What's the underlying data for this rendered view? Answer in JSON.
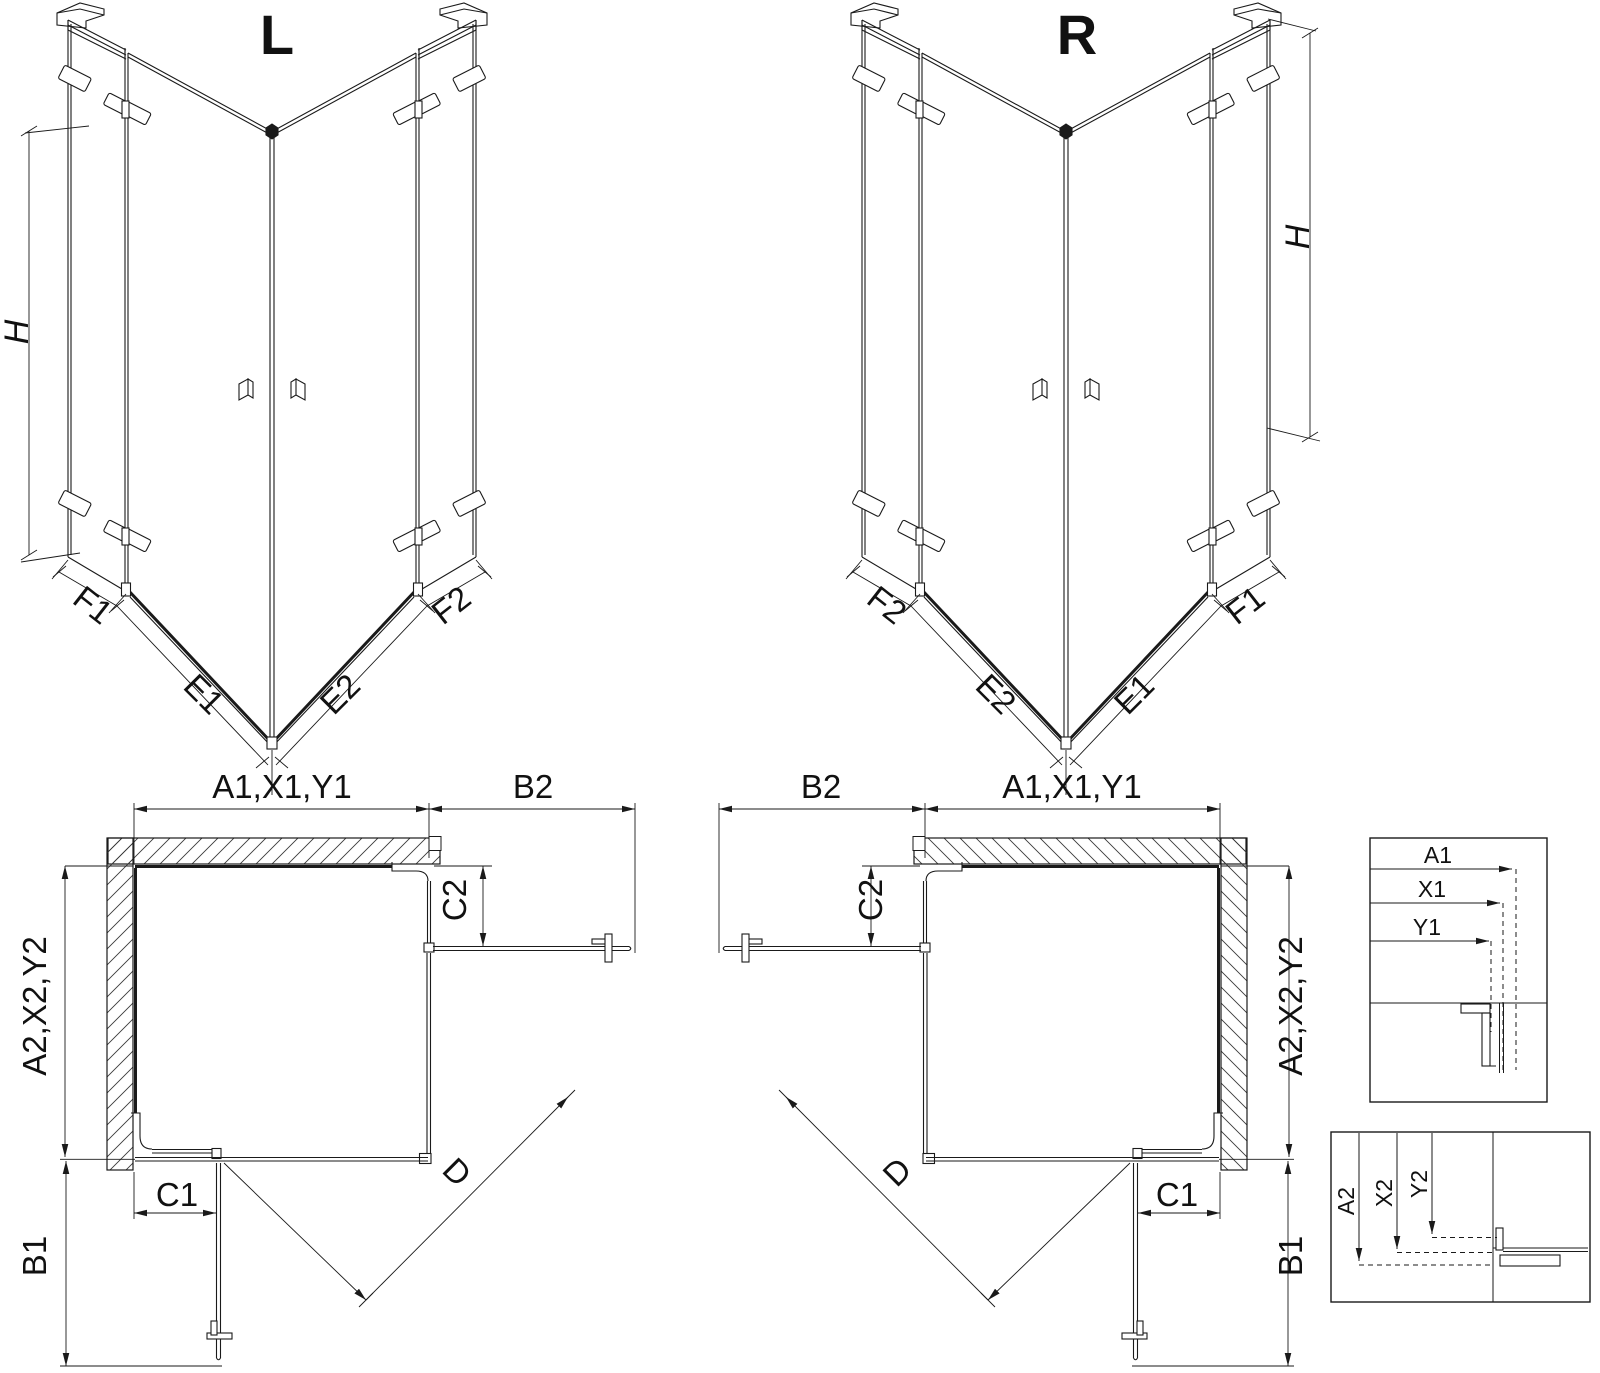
{
  "iso_left": {
    "title": "L",
    "height_label": "H",
    "bottom_labels": [
      "F1",
      "E1",
      "E2",
      "F2"
    ]
  },
  "iso_right": {
    "title": "R",
    "height_label": "H",
    "bottom_labels": [
      "F2",
      "E2",
      "E1",
      "F1"
    ]
  },
  "plan_left": {
    "width_top": "A1,X1,Y1",
    "width_door": "B2",
    "fixed_top": "C2",
    "height_side": "A2,X2,Y2",
    "fixed_bottom": "C1",
    "height_door": "B1",
    "diagonal": "D"
  },
  "plan_right": {
    "width_top": "A1,X1,Y1",
    "width_door": "B2",
    "fixed_top": "C2",
    "height_side": "A2,X2,Y2",
    "fixed_bottom": "C1",
    "height_door": "B1",
    "diagonal": "D"
  },
  "detail_widths": {
    "labels": [
      "A1",
      "X1",
      "Y1"
    ]
  },
  "detail_heights": {
    "labels": [
      "A2",
      "X2",
      "Y2"
    ]
  },
  "colors": {
    "line": "#1a1a1a",
    "background": "#ffffff"
  }
}
